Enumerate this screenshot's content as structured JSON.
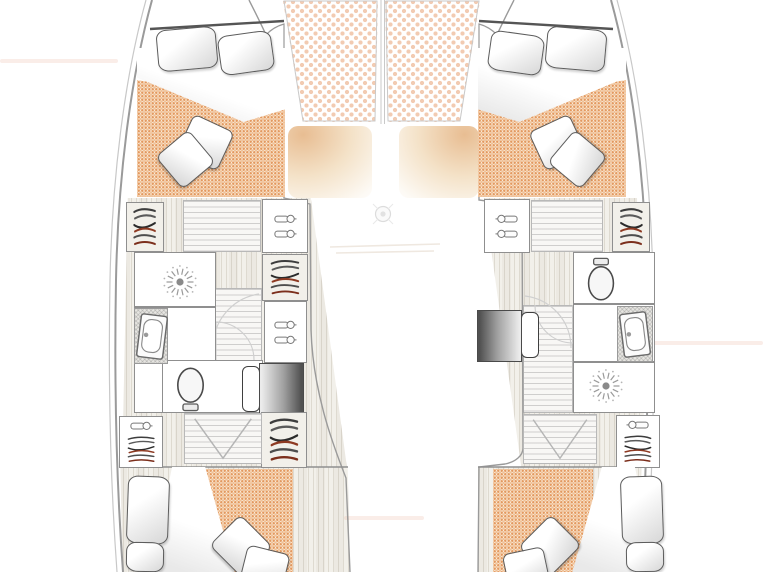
{
  "meta": {
    "title": "Catamaran interior deck plan",
    "view": "top-down floor plan",
    "visible_text": ""
  },
  "palette": {
    "mattress_bg": "#fcf3e7",
    "mattress_dot": "#e3995f",
    "mattress_dot2": "#f0bf92",
    "deck_dot": "#f2cbb2",
    "window_tan": "#e8bd92",
    "wood_base": "#f2f0ea",
    "tread_bg": "#f8f7f5",
    "wall_line": "#8f8f8f",
    "hull_line": "#9a9a9a",
    "hanger_red": "#8e3a22",
    "seat_dark": "#515151"
  },
  "floors": [
    {
      "name": "hull-floor-port",
      "type": "wood",
      "x": 121,
      "y": 198,
      "w": 226,
      "h": 270,
      "clip": "polygon(3% 0,84% 0,100% 100%,0.5% 100%)"
    },
    {
      "name": "hull-floor-starboard",
      "type": "wood",
      "x": 484,
      "y": 198,
      "w": 170,
      "h": 270,
      "clip": "polygon(0 0,90% 0,95% 100%,22% 100%)"
    },
    {
      "name": "aft-cabin-floor-port",
      "type": "wood",
      "x": 118,
      "y": 467,
      "w": 232,
      "h": 105,
      "clip": "polygon(1% 0,99% 0,100% 100%,2% 100%)"
    },
    {
      "name": "aft-cabin-floor-starboard",
      "type": "wood",
      "x": 478,
      "y": 467,
      "w": 167,
      "h": 105,
      "clip": "polygon(0 0,98% 0,96% 100%,0 100%)"
    },
    {
      "name": "foredeck-pad-port",
      "type": "deckpad",
      "x": 283,
      "y": 1,
      "w": 95,
      "h": 121,
      "clip": "polygon(0 0,100% 0,97% 100%,21% 100%)"
    },
    {
      "name": "foredeck-pad-starboard",
      "type": "deckpad",
      "x": 385,
      "y": 1,
      "w": 95,
      "h": 121,
      "clip": "polygon(0 0,100% 0,79% 100%,3% 100%)"
    },
    {
      "name": "salon-window-port",
      "type": "window",
      "x": 288,
      "y": 126,
      "w": 84,
      "h": 72
    },
    {
      "name": "salon-window-starboard",
      "type": "window",
      "x": 399,
      "y": 126,
      "w": 80,
      "h": 72,
      "flip": 1
    },
    {
      "name": "companionway-port",
      "type": "treads",
      "x": 183,
      "y": 200,
      "w": 78,
      "h": 52
    },
    {
      "name": "corridor-port",
      "type": "treads",
      "x": 211,
      "y": 288,
      "w": 51,
      "h": 74
    },
    {
      "name": "companionway-starboard",
      "type": "treads",
      "x": 531,
      "y": 200,
      "w": 72,
      "h": 52
    },
    {
      "name": "corridor-starboard",
      "type": "treads",
      "x": 523,
      "y": 305,
      "w": 50,
      "h": 108
    },
    {
      "name": "shadow-streak",
      "type": "streak",
      "x": 0,
      "y": 59,
      "w": 118,
      "h": 4
    },
    {
      "name": "shadow-streak",
      "type": "streak",
      "x": 650,
      "y": 341,
      "w": 113,
      "h": 4
    },
    {
      "name": "shadow-streak",
      "type": "streak",
      "x": 344,
      "y": 516,
      "w": 80,
      "h": 4
    }
  ],
  "fixtures": [
    {
      "name": "forward-berth-mattress-port",
      "type": "mattress",
      "x": 137,
      "y": 70,
      "w": 148,
      "h": 127,
      "clip": "polygon(0 8%,100% 26%,100% 100%,0 100%)"
    },
    {
      "name": "forward-berth-sheet-port",
      "type": "sheet",
      "x": 137,
      "y": 48,
      "w": 148,
      "h": 74,
      "clip": "polygon(0 0,100% 0,100% 83%,72% 100%,0 40%)"
    },
    {
      "name": "pillow",
      "type": "pillow",
      "x": 157,
      "y": 28,
      "w": 60,
      "h": 42,
      "rot": -5
    },
    {
      "name": "pillow",
      "type": "pillow",
      "x": 219,
      "y": 33,
      "w": 54,
      "h": 40,
      "rot": -8
    },
    {
      "name": "throw-pillow",
      "type": "throw",
      "x": 183,
      "y": 121,
      "w": 45,
      "h": 43,
      "rot": 25
    },
    {
      "name": "throw-pillow",
      "type": "throw",
      "x": 164,
      "y": 138,
      "w": 43,
      "h": 43,
      "rot": 50
    },
    {
      "name": "wardrobe-rail-locker",
      "type": "locker wood",
      "x": 126,
      "y": 202,
      "w": 38,
      "h": 50,
      "icons": [
        "rail"
      ]
    },
    {
      "name": "wardrobe-hook-locker",
      "type": "locker",
      "x": 262,
      "y": 199,
      "w": 46,
      "h": 54,
      "icons": [
        "hook",
        "hook"
      ]
    },
    {
      "name": "wardrobe-rail-locker",
      "type": "locker wood",
      "x": 262,
      "y": 254,
      "w": 46,
      "h": 47,
      "icons": [
        "rail"
      ]
    },
    {
      "name": "wardrobe-hook-locker",
      "type": "locker",
      "x": 264,
      "y": 301,
      "w": 43,
      "h": 62,
      "icons": [
        "hook",
        "hook"
      ]
    },
    {
      "name": "bathroom-port",
      "type": "room",
      "x": 134,
      "y": 252,
      "w": 82,
      "h": 161
    },
    {
      "name": "toilet-room-port",
      "type": "room",
      "x": 162,
      "y": 360,
      "w": 101,
      "h": 53
    },
    {
      "name": "wall",
      "type": "wall",
      "x": 134,
      "y": 306,
      "w": 82,
      "h": 2
    },
    {
      "name": "shower-head-icon",
      "type": "icon shower",
      "x": 160,
      "y": 262,
      "w": 40,
      "h": 40,
      "glyph": "shower"
    },
    {
      "name": "sink-counter",
      "type": "hatch",
      "x": 134,
      "y": 308,
      "w": 34,
      "h": 56
    },
    {
      "name": "sink-icon",
      "type": "icon sink",
      "x": 138,
      "y": 314,
      "w": 28,
      "h": 45,
      "rot": 7,
      "glyph": "sink"
    },
    {
      "name": "toilet-icon",
      "type": "icon toilet",
      "x": 172,
      "y": 365,
      "w": 37,
      "h": 47,
      "rot": 180,
      "glyph": "toilet"
    },
    {
      "name": "seat-back",
      "type": "seatback",
      "x": 242,
      "y": 366,
      "w": 18,
      "h": 46
    },
    {
      "name": "nav-seat",
      "type": "seat",
      "x": 259,
      "y": 363,
      "w": 45,
      "h": 52
    },
    {
      "name": "wardrobe-hook-rail-locker",
      "type": "locker",
      "x": 119,
      "y": 416,
      "w": 44,
      "h": 52,
      "icons": [
        "hook",
        "rail"
      ]
    },
    {
      "name": "wardrobe-rail-locker",
      "type": "locker wood",
      "x": 261,
      "y": 412,
      "w": 46,
      "h": 56,
      "icons": [
        "rail"
      ]
    },
    {
      "name": "stairs-aft-port",
      "type": "stairs",
      "x": 184,
      "y": 413,
      "w": 78,
      "h": 51,
      "icons": [
        "chevron"
      ]
    },
    {
      "name": "aft-berth-mattress-port",
      "type": "mattress",
      "x": 188,
      "y": 469,
      "w": 105,
      "h": 103
    },
    {
      "name": "aft-berth-sheet-port",
      "type": "sheet",
      "x": 150,
      "y": 467,
      "w": 92,
      "h": 105,
      "clip": "polygon(24% 0,60% 0,92% 100%,0 100%)"
    },
    {
      "name": "pillow",
      "type": "pillow",
      "x": 127,
      "y": 476,
      "w": 42,
      "h": 68,
      "rot": 2
    },
    {
      "name": "pillow",
      "type": "pillow",
      "x": 126,
      "y": 542,
      "w": 38,
      "h": 30,
      "rot": 1
    },
    {
      "name": "throw-pillow",
      "type": "throw",
      "x": 218,
      "y": 524,
      "w": 46,
      "h": 44,
      "rot": 45
    },
    {
      "name": "throw-pillow",
      "type": "throw",
      "x": 243,
      "y": 549,
      "w": 44,
      "h": 37,
      "rot": 14
    },
    {
      "name": "forward-berth-mattress-starboard",
      "type": "mattress",
      "x": 478,
      "y": 70,
      "w": 148,
      "h": 127,
      "clip": "polygon(0 26%,100% 8%,100% 100%,0 100%)"
    },
    {
      "name": "forward-berth-sheet-starboard",
      "type": "sheet",
      "x": 478,
      "y": 48,
      "w": 148,
      "h": 74,
      "clip": "polygon(0 0,100% 0,100% 40%,28% 100%,0 83%)"
    },
    {
      "name": "pillow",
      "type": "pillow",
      "x": 489,
      "y": 33,
      "w": 54,
      "h": 40,
      "rot": 8
    },
    {
      "name": "pillow",
      "type": "pillow",
      "x": 546,
      "y": 28,
      "w": 60,
      "h": 42,
      "rot": 5
    },
    {
      "name": "throw-pillow",
      "type": "throw",
      "x": 535,
      "y": 121,
      "w": 45,
      "h": 43,
      "rot": -25
    },
    {
      "name": "throw-pillow",
      "type": "throw",
      "x": 556,
      "y": 138,
      "w": 43,
      "h": 43,
      "rot": -50
    },
    {
      "name": "wardrobe-hook-locker",
      "type": "locker",
      "x": 484,
      "y": 199,
      "w": 46,
      "h": 54,
      "icons": [
        "hook",
        "hook"
      ],
      "flip": 1
    },
    {
      "name": "wardrobe-rail-locker",
      "type": "locker wood",
      "x": 612,
      "y": 202,
      "w": 38,
      "h": 50,
      "icons": [
        "rail"
      ],
      "flip": 1
    },
    {
      "name": "bathroom-starboard",
      "type": "room",
      "x": 573,
      "y": 252,
      "w": 82,
      "h": 161
    },
    {
      "name": "wall",
      "type": "wall",
      "x": 573,
      "y": 303,
      "w": 82,
      "h": 2
    },
    {
      "name": "wall",
      "type": "wall",
      "x": 573,
      "y": 361,
      "w": 82,
      "h": 2
    },
    {
      "name": "toilet-icon",
      "type": "icon toilet",
      "x": 583,
      "y": 257,
      "w": 36,
      "h": 46,
      "glyph": "toilet"
    },
    {
      "name": "sink-counter",
      "type": "hatch",
      "x": 617,
      "y": 306,
      "w": 36,
      "h": 56
    },
    {
      "name": "sink-icon",
      "type": "icon sink",
      "x": 621,
      "y": 312,
      "w": 28,
      "h": 45,
      "rot": -7,
      "glyph": "sink"
    },
    {
      "name": "shower-head-icon",
      "type": "icon shower",
      "x": 586,
      "y": 366,
      "w": 40,
      "h": 40,
      "glyph": "shower"
    },
    {
      "name": "seat-back",
      "type": "seatback",
      "x": 521,
      "y": 312,
      "w": 18,
      "h": 46
    },
    {
      "name": "nav-seat",
      "type": "seat",
      "x": 477,
      "y": 310,
      "w": 45,
      "h": 52,
      "flip": 1
    },
    {
      "name": "wardrobe-hook-rail-locker",
      "type": "locker",
      "x": 616,
      "y": 415,
      "w": 44,
      "h": 53,
      "icons": [
        "hook",
        "rail"
      ],
      "flip": 1
    },
    {
      "name": "stairs-aft-starboard",
      "type": "stairs",
      "x": 523,
      "y": 414,
      "w": 74,
      "h": 50,
      "icons": [
        "chevron"
      ]
    },
    {
      "name": "aft-berth-mattress-starboard",
      "type": "mattress",
      "x": 493,
      "y": 469,
      "w": 100,
      "h": 103
    },
    {
      "name": "aft-berth-sheet-starboard",
      "type": "sheet",
      "x": 565,
      "y": 467,
      "w": 92,
      "h": 105,
      "clip": "polygon(40% 0,76% 0,100% 100%,8% 100%)"
    },
    {
      "name": "pillow",
      "type": "pillow",
      "x": 621,
      "y": 476,
      "w": 42,
      "h": 68,
      "rot": -2
    },
    {
      "name": "pillow",
      "type": "pillow",
      "x": 626,
      "y": 542,
      "w": 38,
      "h": 30,
      "rot": -1
    },
    {
      "name": "throw-pillow",
      "type": "throw",
      "x": 527,
      "y": 524,
      "w": 46,
      "h": 44,
      "rot": -45
    },
    {
      "name": "throw-pillow",
      "type": "throw",
      "x": 505,
      "y": 550,
      "w": 42,
      "h": 36,
      "rot": -12
    }
  ]
}
